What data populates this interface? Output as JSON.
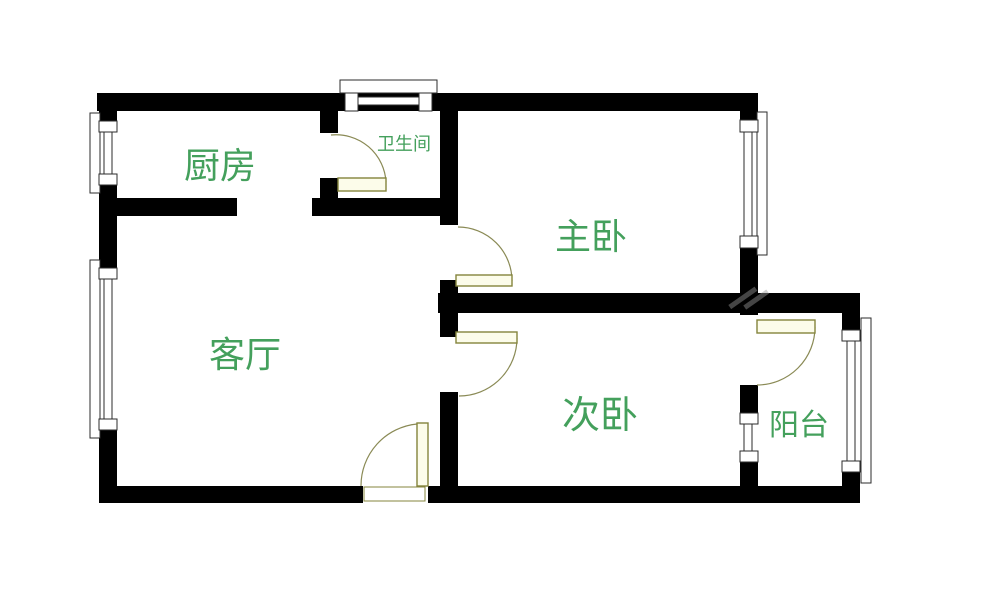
{
  "plan": {
    "type": "apartment-floor-plan",
    "rooms": {
      "kitchen": {
        "label": "厨房"
      },
      "bathroom": {
        "label": "卫生间"
      },
      "master_bedroom": {
        "label": "主卧"
      },
      "living_room": {
        "label": "客厅"
      },
      "second_bedroom": {
        "label": "次卧"
      },
      "balcony": {
        "label": "阳台"
      }
    },
    "features": {
      "doors": [
        "bathroom-door",
        "master-bedroom-door",
        "second-bedroom-door",
        "balcony-door",
        "entrance-door"
      ],
      "windows": [
        "kitchen-left-window",
        "living-room-left-window",
        "bathroom-top-window",
        "master-bedroom-right-window",
        "balcony-right-window",
        "bedroom-balcony-window"
      ]
    }
  },
  "colors": {
    "wall": "#000000",
    "background": "#ffffff",
    "label_green": "#44a05c",
    "door_fill": "#fcfcea",
    "door_stroke": "#84843c",
    "door_arc": "#8a8a55",
    "window_stroke": "#2b2b2b"
  }
}
